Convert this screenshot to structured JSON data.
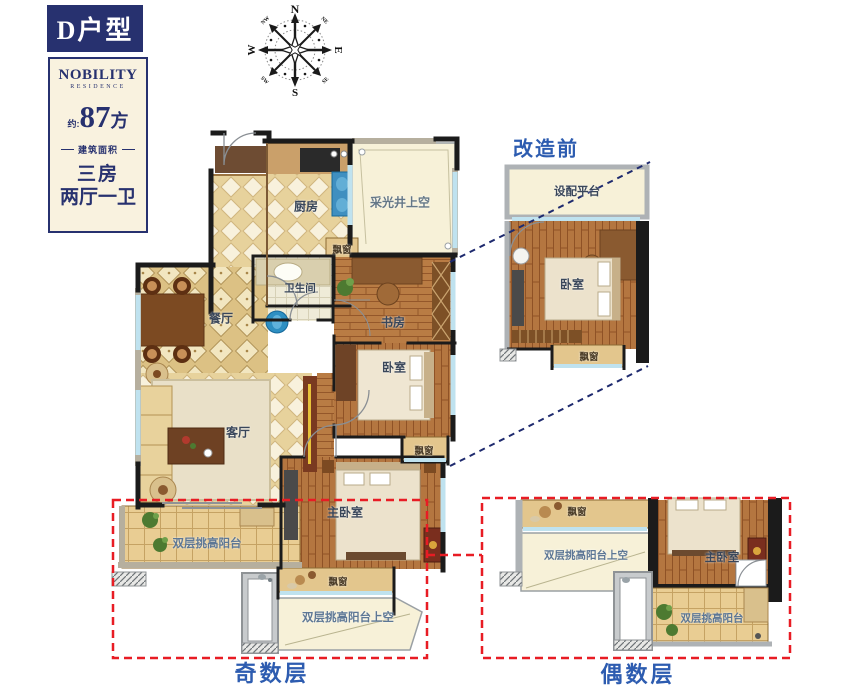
{
  "sidebar": {
    "unit_type": "D户型",
    "brand_name": "NOBILITY",
    "brand_sub": "RESIDENCE",
    "area_prefix": "约:",
    "area_number": "87",
    "area_unit": "方",
    "area_caption": "建筑面积",
    "layout_rooms": "三房",
    "layout_halls": "两厅一卫"
  },
  "compass": {
    "n": "N",
    "e": "E",
    "s": "S",
    "w": "W",
    "ne": "NE",
    "nw": "NW",
    "se": "SE",
    "sw": "SW"
  },
  "main_plan": {
    "rooms": {
      "kitchen": "厨房",
      "light_well": "采光井上空",
      "bay_window_top": "飘窗",
      "bathroom": "卫生间",
      "study": "书房",
      "bedroom": "卧室",
      "dining": "餐厅",
      "living": "客厅",
      "master_bedroom": "主卧室",
      "bay_window_right": "飘窗",
      "balcony": "双层挑高阳台",
      "bay_window_bottom": "飘窗",
      "balcony_above": "双层挑高阳台上空"
    }
  },
  "inset_before": {
    "title": "改造前",
    "rooms": {
      "platform": "设配平台",
      "bedroom": "卧室",
      "bay_window": "飘窗"
    }
  },
  "inset_even": {
    "rooms": {
      "bay_window": "飘窗",
      "balcony_above": "双层挑高阳台上空",
      "master_bedroom": "主卧室",
      "balcony": "双层挑高阳台"
    }
  },
  "captions": {
    "odd_floors": "奇数层",
    "even_floors": "偶数层"
  },
  "colors": {
    "navy": "#27316f",
    "blue_label": "#2d5cb0",
    "red_dashed": "#e81c24",
    "cream_panel": "#f9f2df",
    "wood_floor": "#b97c44",
    "tile_cream": "#e9d6a2",
    "bay_tan": "#e3c68d",
    "void_pale": "#f7f1d8"
  }
}
